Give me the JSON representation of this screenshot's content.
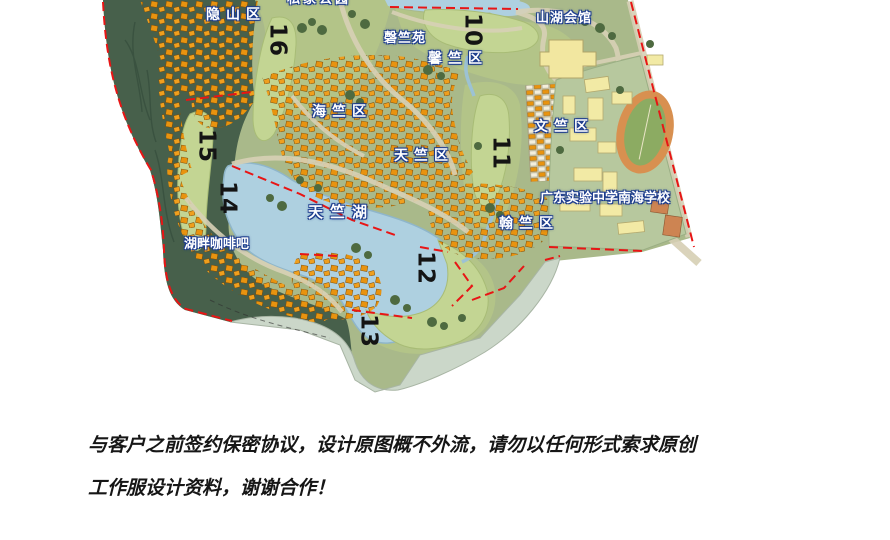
{
  "map": {
    "title_hint": "resort master plan",
    "labels": [
      {
        "name": "private-park",
        "text": "私家公园"
      },
      {
        "name": "yinshan-district",
        "text": "隐山区"
      },
      {
        "name": "shanhu-club",
        "text": "山湖会馆"
      },
      {
        "name": "qingzhu-garden",
        "text": "磬竺苑"
      },
      {
        "name": "xinzhu-district",
        "text": "馨竺区"
      },
      {
        "name": "haizhu-district",
        "text": "海竺区"
      },
      {
        "name": "wenzhu-district",
        "text": "文竺区"
      },
      {
        "name": "tianzhu-district",
        "text": "天竺区"
      },
      {
        "name": "tianzhu-lake",
        "text": "天竺湖"
      },
      {
        "name": "guangdong-experimental-school",
        "text": "广东实验中学南海学校"
      },
      {
        "name": "hanzhu-district",
        "text": "翰竺区"
      },
      {
        "name": "lakeside-coffee-bar",
        "text": "湖畔咖啡吧"
      }
    ],
    "hole_numbers": [
      {
        "value": "16"
      },
      {
        "value": "10"
      },
      {
        "value": "15"
      },
      {
        "value": "14"
      },
      {
        "value": "11"
      },
      {
        "value": "12"
      },
      {
        "value": "13"
      }
    ],
    "colors": {
      "forest": "#47604b",
      "development_base": "#a9b98a",
      "park_green": "#b3c488",
      "fairway": "#c3d593",
      "lake": "#aed0e0",
      "villa_orange": "#e8930f",
      "school_base": "#b7c89e",
      "school_building": "#f2eaa5",
      "track_ring": "#d89050",
      "track_field": "#8cab62",
      "shore_band": "#cbd7c9",
      "boundary_red": "#e81515",
      "label_outline_blue": "#1c3c8e",
      "road_tan": "#d8d1b6"
    }
  },
  "disclaimer": {
    "line1": "与客户之前签约保密协议，设计原图概不外流，请勿以任何形式索求原创",
    "line2": "工作服设计资料，谢谢合作！"
  }
}
